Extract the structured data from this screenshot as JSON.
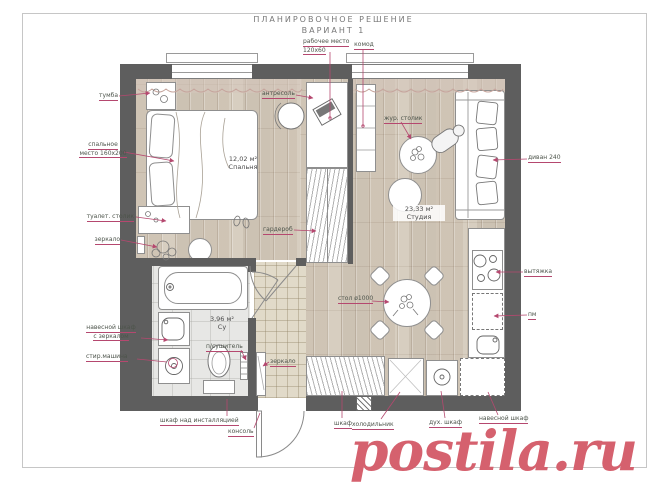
{
  "title": {
    "line1": "ПЛАНИРОВОЧНОЕ РЕШЕНИЕ",
    "line2": "ВАРИАНТ 1"
  },
  "watermark": "postila.ru",
  "rooms": {
    "bedroom": {
      "area": "12,02 м²",
      "name": "Спальня"
    },
    "studio": {
      "area": "23,33 м²",
      "name": "Студия"
    },
    "bathroom": {
      "area": "3,96 м²",
      "name": "Су"
    }
  },
  "labels": {
    "tumba": "тумба",
    "sleeping_place_1": "спальное",
    "sleeping_place_2": "место 160х200",
    "dressing_table": "туалет. столик",
    "mirror_bedroom": "зеркало",
    "workplace_1": "рабочее место",
    "workplace_2": "120х60",
    "komod": "комод",
    "antresol": "антресоль",
    "garderob": "гардероб",
    "jur_table": "жур. столик",
    "sofa": "диван 240",
    "hood": "вытяжка",
    "pm": "пм",
    "dining_table": "стол ø1000",
    "mirror_hall": "зеркало",
    "towel_dryer": "п/сушитель",
    "wall_cab_mirror_1": "навесной шкаф",
    "wall_cab_mirror_2": "с зеркалом",
    "washing_machine": "стир.машина",
    "cabinet_installation": "шкаф над инсталляцией",
    "console": "консоль",
    "wardrobe_hall": "шкаф",
    "fridge": "холодильник",
    "oven": "дух. шкаф",
    "wall_cabinet": "навесной шкаф"
  },
  "colors": {
    "wall": "#5e5e5e",
    "leader": "#b5486f",
    "label_text": "#4d544b",
    "title_text": "#787878",
    "watermark": "#d5616e",
    "furn_line": "#8f8f8f",
    "curtain": "#c6a59d",
    "wood_floor": "#d2c9bb",
    "tile_floor": "#e1dac9",
    "bath_floor": "#e7e7e5"
  }
}
